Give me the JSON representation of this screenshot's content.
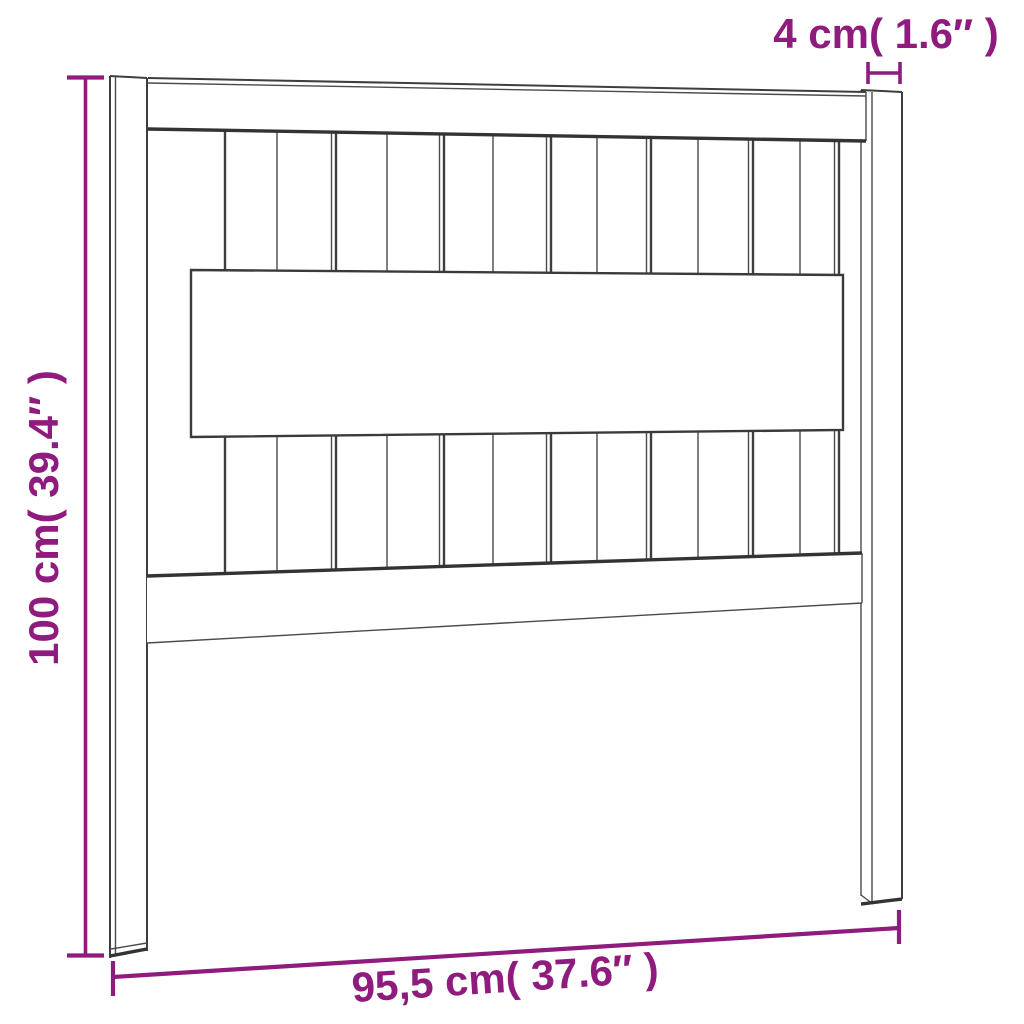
{
  "diagram": {
    "subject": "slatted-headboard",
    "background_color": "#ffffff",
    "line_color": "#3e3e3e",
    "accent_color": "#8e1b7d",
    "labels": {
      "height": "100 cm( 39.4″ )",
      "post_width": "4 cm( 1.6″ )",
      "width": "95,5 cm( 37.6″ )"
    }
  }
}
